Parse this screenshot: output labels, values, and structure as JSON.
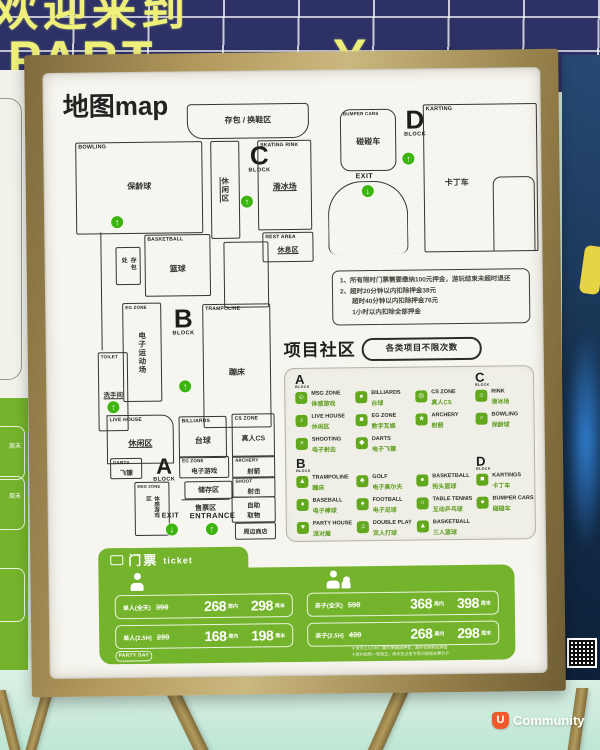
{
  "banner": {
    "line1": "欢迎来到",
    "frag_part": "PART",
    "frag_dash": "-",
    "frag_y": "Y"
  },
  "icons": {
    "arrow_up": "↑",
    "arrow_down": "↓"
  },
  "poster": {
    "title": "地图map",
    "map": {
      "labels": {
        "a": "A",
        "b": "B",
        "c": "C",
        "d": "D",
        "block": "BLOCK",
        "exit": "EXIT",
        "entrance": "ENTRANCE"
      },
      "locker": {
        "zh": "存包 / 换鞋区"
      },
      "bowling": {
        "en": "BOWLING",
        "zh": "保龄球"
      },
      "lounge": {
        "zh": "休闲区"
      },
      "skating": {
        "en": "SKATING RINK",
        "zh": "滑冰场"
      },
      "bumper": {
        "en": "BUMPER CARS",
        "zh": "碰碰车"
      },
      "karting": {
        "en": "KARTING",
        "zh": "卡丁车"
      },
      "basketball": {
        "en": "BASKETBALL",
        "zh": "篮球"
      },
      "locker2": {
        "zh": "存包处"
      },
      "rest": {
        "en": "REST AREA",
        "zh": "休息区"
      },
      "eg_strip": {
        "en": "EG ZONE",
        "zh": "电子运动场"
      },
      "trampoline": {
        "en": "TRAMPOLINE",
        "zh": "蹦床"
      },
      "toilet": {
        "en": "TOILET",
        "zh": "洗手间"
      },
      "livehouse": {
        "en": "LIVE HOUSE",
        "zh": "休闲区"
      },
      "billiards": {
        "en": "BILLIARDS",
        "zh": "台球"
      },
      "cszone": {
        "en": "CS ZONE",
        "zh": "真人CS"
      },
      "darts": {
        "en": "DARTS",
        "zh": "飞镖"
      },
      "egzone": {
        "en": "EG ZONE",
        "zh": "电子游戏"
      },
      "archery": {
        "en": "ARCHERY",
        "zh": "射箭"
      },
      "shoot": {
        "en": "SHOOT",
        "zh": "射击"
      },
      "msg": {
        "en": "MSG ZONE",
        "zh": "体感游戏区"
      },
      "storage": {
        "zh": "储存区"
      },
      "ticketing": {
        "zh": "售票区"
      },
      "pickup": {
        "zh1": "自助",
        "zh2": "取物"
      },
      "shop": {
        "zh": "周边商店"
      }
    },
    "notes": [
      "1、所有限时门票需要缴纳100元押金，游玩结束未超时退还",
      "2、超时20分钟以内扣除押金38元",
      "超时40分钟以内扣除押金76元",
      "1小时以内扣除全部押金"
    ],
    "section": {
      "title": "项目社区",
      "badge": "各类项目不限次数"
    },
    "legend": {
      "items": [
        {
          "en": "MSG ZONE",
          "zh": "体感游戏",
          "icon": "☺"
        },
        {
          "en": "BILLIARDS",
          "zh": "台球",
          "icon": "●"
        },
        {
          "en": "CS ZONE",
          "zh": "真人CS",
          "icon": "◎"
        },
        {
          "en": "RINK",
          "zh": "滑冰场",
          "icon": "☼"
        },
        {
          "en": "LIVE HOUSE",
          "zh": "休闲区",
          "icon": "♪"
        },
        {
          "en": "EG ZONE",
          "zh": "数字互娱",
          "icon": "■"
        },
        {
          "en": "ARCHERY",
          "zh": "射箭",
          "icon": "★"
        },
        {
          "en": "BOWLING",
          "zh": "保龄球",
          "icon": "○"
        },
        {
          "en": "SHOOTING",
          "zh": "电子射击",
          "icon": "×"
        },
        {
          "en": "DARTS",
          "zh": "电子飞镖",
          "icon": "◆"
        },
        {
          "en": "TRAMPOLINE",
          "zh": "蹦床",
          "icon": "▲"
        },
        {
          "en": "GOLF",
          "zh": "电子高尔夫",
          "icon": "♣"
        },
        {
          "en": "BASKETBALL",
          "zh": "街头篮球",
          "icon": "●"
        },
        {
          "en": "KARTINGS",
          "zh": "卡丁车",
          "icon": "■"
        },
        {
          "en": "BASEBALL",
          "zh": "电子棒球",
          "icon": "♦"
        },
        {
          "en": "FOOTBALL",
          "zh": "电子足球",
          "icon": "♠"
        },
        {
          "en": "TABLE TENNIS",
          "zh": "互动乒乓球",
          "icon": "○"
        },
        {
          "en": "BUMPER CARS",
          "zh": "碰碰车",
          "icon": "●"
        },
        {
          "en": "PARTY HOUSE",
          "zh": "派对屋",
          "icon": "♥"
        },
        {
          "en": "DOUBLE PLAY",
          "zh": "双人打球",
          "icon": "♫"
        },
        {
          "en": "BASKETBALL",
          "zh": "三人篮球",
          "icon": "▲"
        }
      ]
    },
    "ticket": {
      "title_zh": "门票",
      "title_en": "ticket",
      "unit_weekday": "周内",
      "unit_weekend": "周末",
      "badge": "PARTY DAY",
      "fine1": "＊全天/2.5小时门票均需缴纳押金，超时扣除相应押金",
      "fine2": "＊周内指周一至周五，周末及法定节假日按周末票价计",
      "rows": [
        {
          "label": "单人(全天)",
          "old": "398",
          "weekday": "268",
          "weekend": "298"
        },
        {
          "label": "单人(2.5H)",
          "old": "299",
          "weekday": "168",
          "weekend": "198"
        },
        {
          "label": "亲子(全天)",
          "old": "598",
          "weekday": "368",
          "weekend": "398"
        },
        {
          "label": "亲子(2.5H)",
          "old": "499",
          "weekday": "268",
          "weekend": "298"
        }
      ]
    }
  },
  "neighbor_left": {
    "frag1": "周末",
    "frag2": "周末"
  },
  "watermark": {
    "logo": "U",
    "text": "Community"
  }
}
